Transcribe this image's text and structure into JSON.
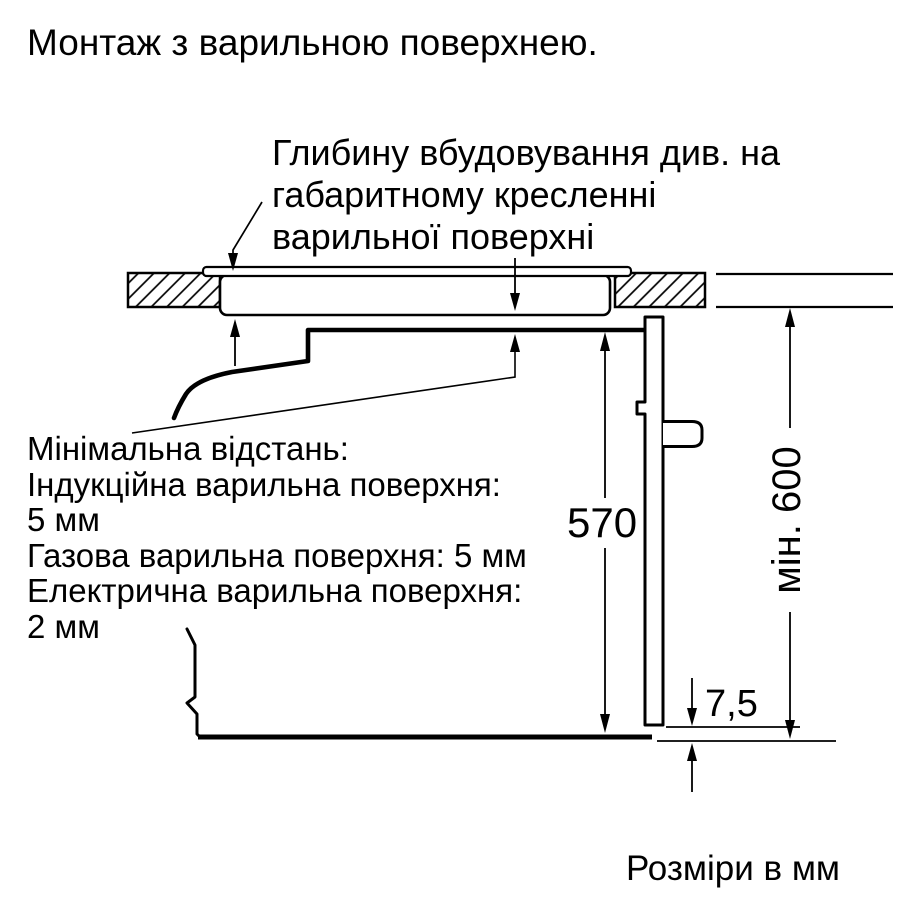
{
  "title": "Монтаж з варильною поверхнею.",
  "callout": {
    "lines": [
      "Глибину вбудовування див. на",
      "габаритному кресленні",
      "варильної поверхні"
    ]
  },
  "min_distance": {
    "lines": [
      "Мінімальна відстань:",
      "Індукційна варильна поверхня:",
      "5 мм",
      "Газова варильна поверхня: 5 мм",
      "Електрична варильна поверхня:",
      "2 мм"
    ]
  },
  "dimensions": {
    "cavity_height": "570",
    "min_niche_height": "мін. 600",
    "bottom_gap": "7,5"
  },
  "units_note": "Розміри в мм",
  "colors": {
    "line": "#000000",
    "background": "#ffffff"
  }
}
